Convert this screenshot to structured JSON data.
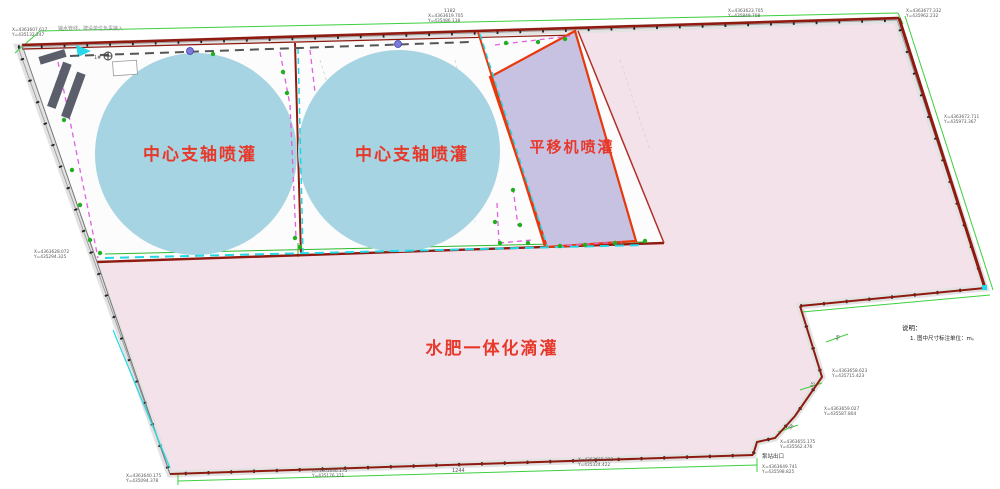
{
  "drawing": {
    "type": "irrigation-site-plan",
    "zones": {
      "pivot1": {
        "label": "中心支轴喷灌",
        "fill": "#a7d4e2"
      },
      "pivot2": {
        "label": "中心支轴喷灌",
        "fill": "#a7d4e2"
      },
      "linear": {
        "label": "平移机喷灌",
        "fill": "#c7c1e2",
        "border": "#e8380c"
      },
      "drip": {
        "label": "水肥一体化滴灌",
        "fill": "#f3e2e9",
        "border": "#8e1a10"
      }
    },
    "notes": {
      "heading": "说明：",
      "items": [
        "1. 图中尺寸标注单位：m。"
      ]
    },
    "labels": {
      "pump_outlet": "泵站出口",
      "pump_station": "1#",
      "supply_note": "输水管线，建设单位负责接入"
    },
    "dimensions": {
      "bottom": "1244",
      "top": "1182",
      "step1": "48",
      "step2": "45",
      "step3": "38"
    },
    "coordinates": {
      "tl": {
        "l1": "X=4363607.617",
        "l2": "Y=435132.247"
      },
      "tc": {
        "l1": "X=4363619.705",
        "l2": "Y=435486.138"
      },
      "tr": {
        "l1": "X=4363623.705",
        "l2": "Y=435849.708"
      },
      "trc": {
        "l1": "X=4363677.332",
        "l2": "Y=435962.232"
      },
      "rm": {
        "l1": "X=4363672.711",
        "l2": "Y=435973.367"
      },
      "lm": {
        "l1": "X=4363628.072",
        "l2": "Y=435294.325"
      },
      "bl": {
        "l1": "X=4363640.175",
        "l2": "Y=435094.378"
      },
      "bl2": {
        "l1": "X=4363646.175",
        "l2": "Y=435176.371"
      },
      "bm": {
        "l1": "X=4363655.322",
        "l2": "Y=435324.422"
      },
      "br1": {
        "l1": "X=4363658.623",
        "l2": "Y=435715.423"
      },
      "br2": {
        "l1": "X=4363659.027",
        "l2": "Y=435587.804"
      },
      "br3": {
        "l1": "X=4363655.175",
        "l2": "Y=435562.476"
      },
      "br4": {
        "l1": "X=4363649.741",
        "l2": "Y=435598.825"
      }
    },
    "palette": {
      "label_red": "#e7392b",
      "boundary_maroon": "#8e1a10",
      "outer_green": "#3ecf3e",
      "drip_cyan": "#22d8e6",
      "lateral_magenta": "#e060e0",
      "road_gray": "#e2e2e2"
    }
  }
}
